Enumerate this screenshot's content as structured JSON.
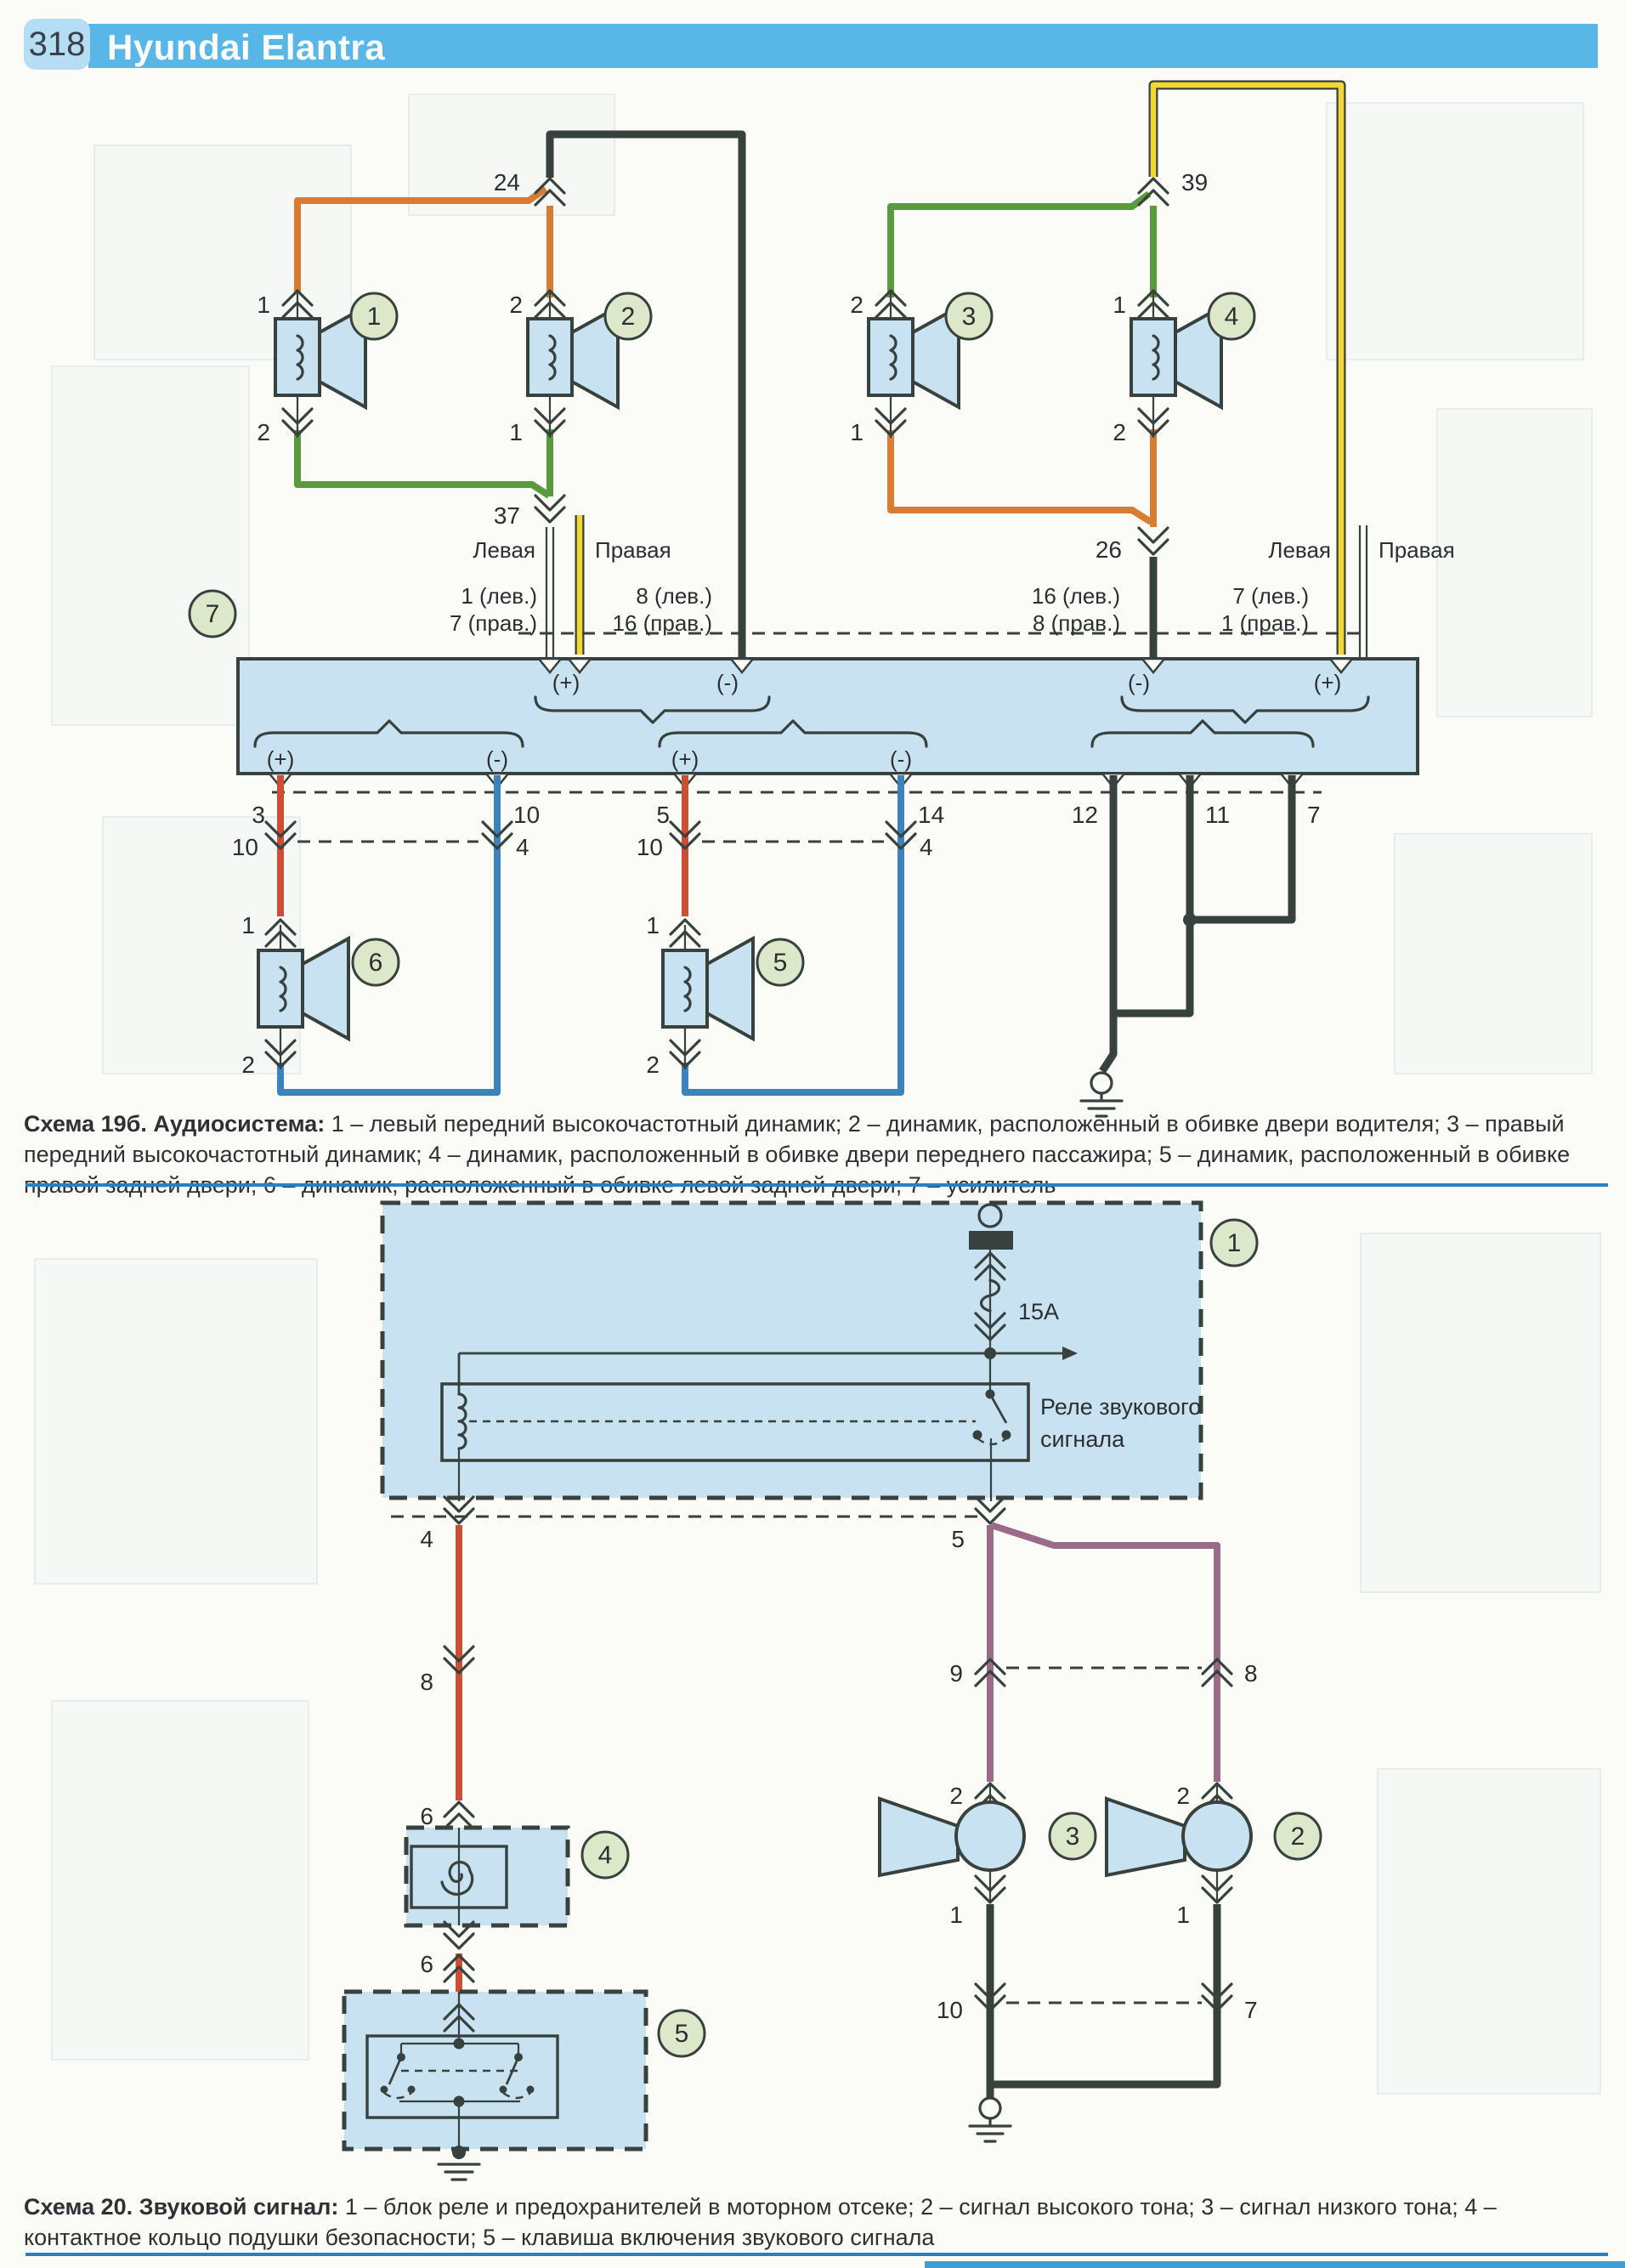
{
  "header": {
    "page": "318",
    "title": "Hyundai Elantra"
  },
  "icons": {
    "connector": "double-chevron",
    "ground": "ground",
    "fuse": "fuse-s-curve",
    "terminal": "power-terminal",
    "speaker": "speaker",
    "horn": "horn",
    "relay_coil": "coil",
    "spiral": "clock-spring-spiral",
    "arrow": "feed-arrow"
  },
  "d1": {
    "badges": {
      "b1": "1",
      "b2": "2",
      "b3": "3",
      "b4": "4",
      "b5": "5",
      "b6": "6",
      "b7": "7"
    },
    "conn": {
      "n24": "24",
      "n37": "37",
      "n39": "39",
      "n26": "26"
    },
    "pins": {
      "p1": "1",
      "p2": "2",
      "p3": "3",
      "p4": "4",
      "p5": "5",
      "p7": "7",
      "p10": "10",
      "p11": "11",
      "p12": "12",
      "p14": "14"
    },
    "sides": {
      "left": "Левая",
      "right": "Правая"
    },
    "amp_pin_labels": {
      "ll1": "1 (лев.)",
      "ll7": "7 (прав.)",
      "lm8": "8 (лев.)",
      "lm16": "16 (прав.)",
      "rm16": "16 (лев.)",
      "rm8": "8 (прав.)",
      "rr7": "7 (лев.)",
      "rr1": "1 (прав.)"
    },
    "polarity": {
      "plus": "(+)",
      "minus": "(-)"
    }
  },
  "d2": {
    "badges": {
      "b1": "1",
      "b2": "2",
      "b3": "3",
      "b4": "4",
      "b5": "5"
    },
    "fuse": "15A",
    "relay_line1": "Реле звукового",
    "relay_line2": "сигнала",
    "pins": {
      "p1": "1",
      "p2": "2",
      "p4": "4",
      "p5": "5",
      "p6": "6",
      "p7": "7",
      "p8": "8",
      "p9": "9",
      "p10": "10"
    }
  },
  "cap1": {
    "bold": "Схема 19б. Аудиосистема:",
    "text": " 1 – левый передний высокочастотный динамик; 2 – динамик, расположенный в обивке двери водителя; 3 – правый передний высокочастотный динамик; 4 – динамик, расположенный в обивке двери переднего пассажира; 5 – динамик, расположенный в обивке правой задней двери; 6 – динамик, расположенный в обивке левой задней двери; 7 – усилитель"
  },
  "cap2": {
    "bold": "Схема 20. Звуковой сигнал:",
    "text": " 1 – блок реле и предохранителей в моторном отсеке; 2 – сигнал высокого тона; 3 – сигнал низкого тона; 4 – контактное кольцо подушки безопасности; 5 – клавиша включения звукового сигнала"
  },
  "colors": {
    "header_bar": "#58b7e6",
    "page_badge_bg": "#b5ddf3",
    "wire_orange": "#d97b33",
    "wire_green": "#5a9a3e",
    "wire_yellow": "#f2d832",
    "wire_dark": "#37413d",
    "wire_red": "#cb4f35",
    "wire_blue": "#3c82bd",
    "wire_purple": "#9a6b86",
    "box_fill": "#c9e2f2",
    "badge_fill": "#dde7c9",
    "divider": "#2a80c2",
    "ink": "#2b2f31"
  }
}
